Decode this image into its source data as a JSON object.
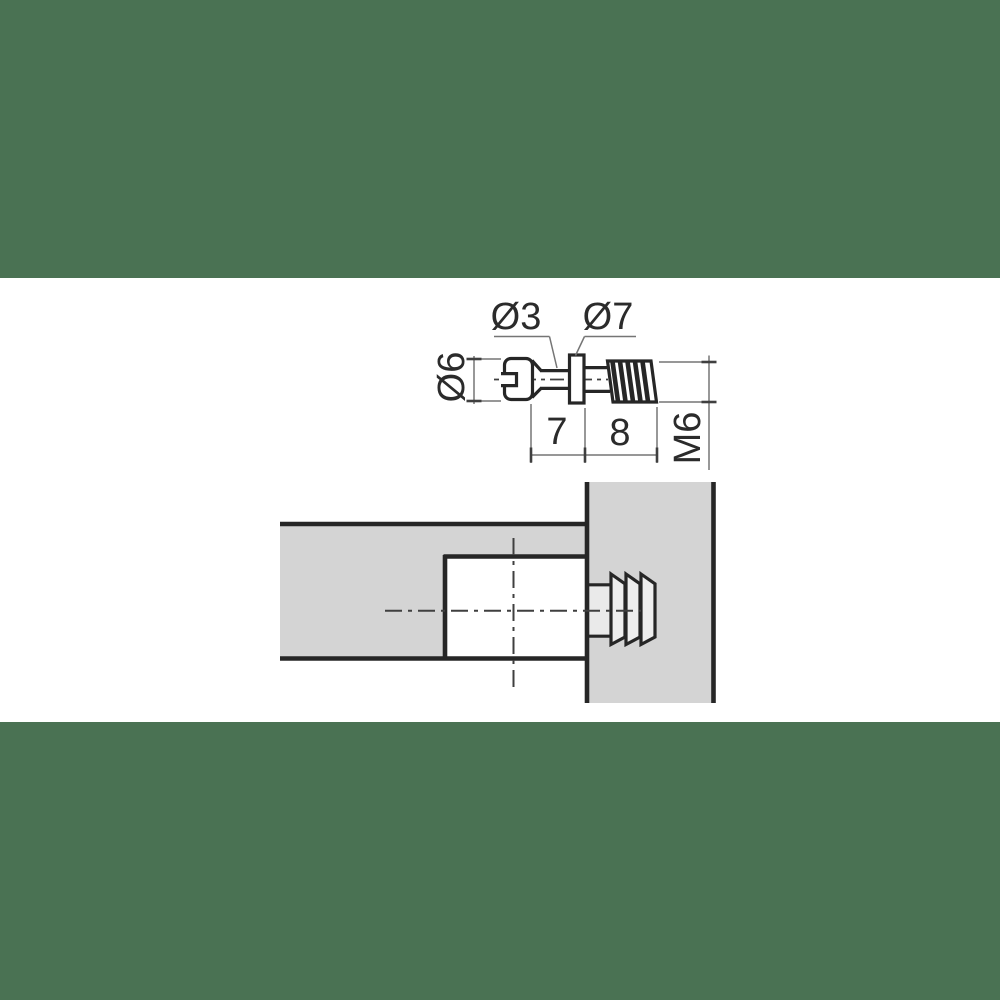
{
  "drawing": {
    "type": "technical-drawing",
    "subject": "furniture connecting dowel screw, dimensioned side view and installed cross-section",
    "views": [
      "dimensioned side view",
      "installed section through two panels"
    ]
  },
  "top_view": {
    "labels": {
      "shaft_diameter": "Ø3",
      "collar_diameter": "Ø7",
      "head_diameter": "Ø6",
      "neck_length": "7",
      "thread_length": "8",
      "thread_size": "M6"
    }
  },
  "colors": {
    "band_green": "#4A7253",
    "panel_gray": "#D4D4D4",
    "fitting_light_gray": "#EAEAEA",
    "line_dark": "#262626",
    "dim_line_gray": "#757575",
    "background": "#FFFFFF"
  }
}
